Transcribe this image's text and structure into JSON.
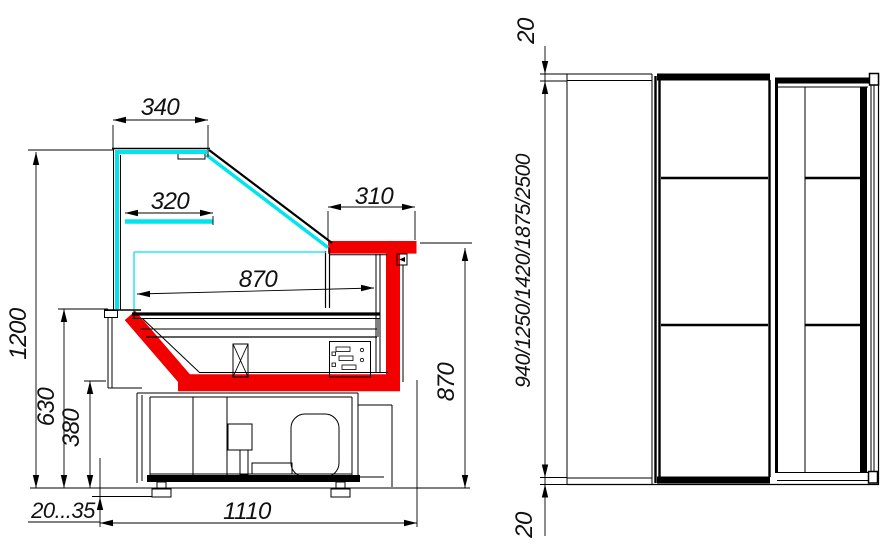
{
  "colors": {
    "line": "#000000",
    "accent_red": "#f20000",
    "glass_cyan": "#00e4ee",
    "background": "#ffffff"
  },
  "section_view": {
    "dim_top_width": "340",
    "dim_shelf_width": "320",
    "dim_canopy_width": "310",
    "dim_display_depth": "870",
    "dim_total_height": "1200",
    "dim_front_height": "630",
    "dim_base_front_height": "380",
    "dim_leg_adjust_range": "20...35",
    "dim_base_length": "1110",
    "dim_worktop_height": "870"
  },
  "plan_view": {
    "dim_end_overhang_top": "20",
    "dim_end_overhang_bottom": "20",
    "dim_length_options": "940/1250/1420/1875/2500"
  }
}
